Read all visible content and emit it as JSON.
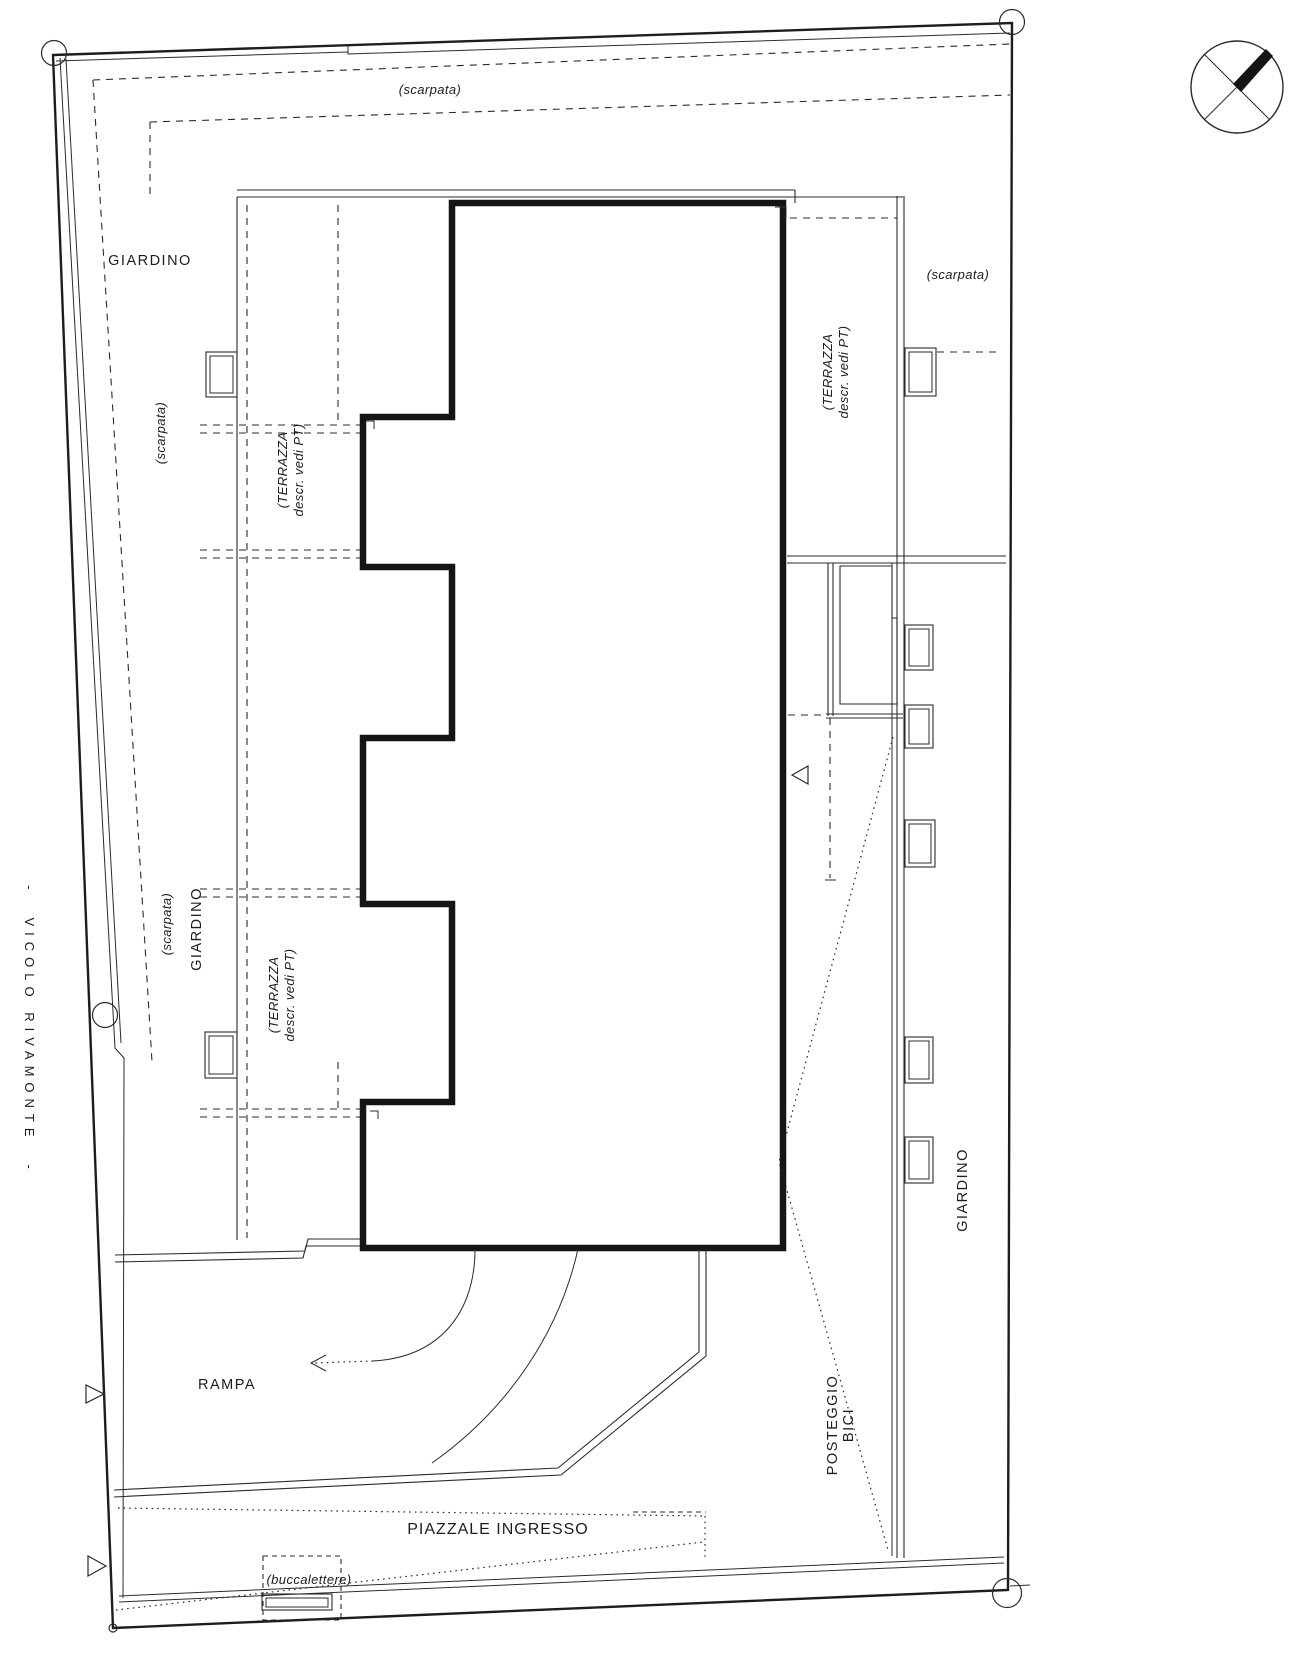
{
  "document": {
    "type": "architectural-site-plan",
    "language": "it"
  },
  "colors": {
    "paper": "#ffffff",
    "ink": "#2b2b2b",
    "building_outline": "#151515"
  },
  "icons": {
    "compass": "north-arrow-compass-icon",
    "survey_marker": "survey-point-circle",
    "direction_marker": "triangle-marker"
  },
  "labels": {
    "giardino_top": "GIARDINO",
    "giardino_left": "GIARDINO",
    "giardino_right": "GIARDINO",
    "scarpata_top": "(scarpata)",
    "scarpata_left_upper": "(scarpata)",
    "scarpata_left_lower": "(scarpata)",
    "scarpata_right": "(scarpata)",
    "terrazza": {
      "line1": "(TERRAZZA",
      "line2": "descr. vedi PT)"
    },
    "rampa": "RAMPA",
    "piazzale_ingresso": "PIAZZALE INGRESSO",
    "posteggio": {
      "line1": "POSTEGGIO",
      "line2": "BICI"
    },
    "buccalettere": "(buccalettere)",
    "street": {
      "dash": "-",
      "name": "VICOLO RIVAMONTE"
    }
  }
}
